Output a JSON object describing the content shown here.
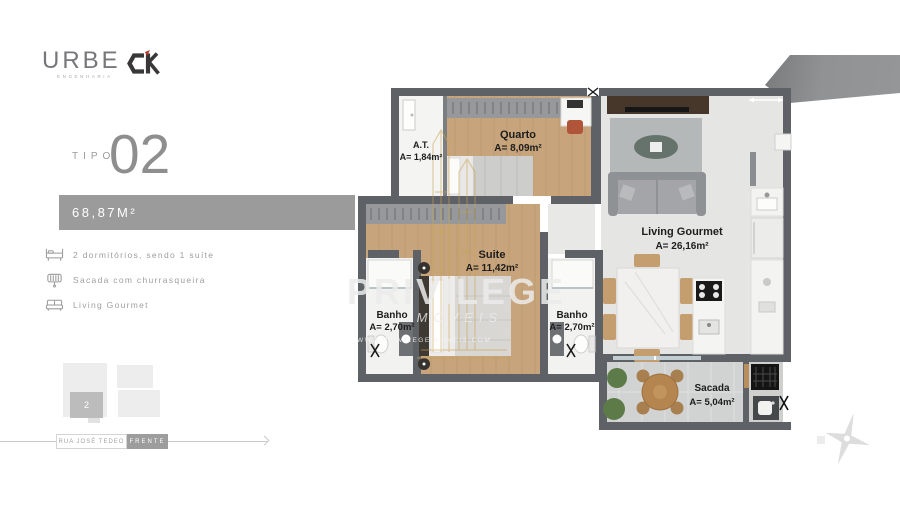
{
  "header": {
    "urbe_logo": "URBE",
    "urbe_tagline": "ENGENHARIA",
    "ck_logo": "CK"
  },
  "sidebar": {
    "tipo_label": "TIPO",
    "tipo_number": "02",
    "area_total": "68,87M²",
    "features": [
      {
        "icon": "bed-icon",
        "label": "2 dormitórios, sendo 1 suíte"
      },
      {
        "icon": "grill-icon",
        "label": "Sacada com churrasqueira"
      },
      {
        "icon": "sofa-icon",
        "label": "Living Gourmet"
      }
    ],
    "keyplan": {
      "unit_number": "2"
    },
    "street": {
      "name": "RUA JOSÉ TEDEO",
      "front": "FRENTE"
    }
  },
  "plan": {
    "rooms": [
      {
        "name": "A.T.",
        "area": "A= 1,84m²"
      },
      {
        "name": "Quarto",
        "area": "A= 8,09m²"
      },
      {
        "name": "Suite",
        "area": "A= 11,42m²"
      },
      {
        "name": "Banho",
        "area": "A= 2,70m²"
      },
      {
        "name": "Banho",
        "area": "A= 2,70m²"
      },
      {
        "name": "Living Gourmet",
        "area": "A= 26,16m²"
      },
      {
        "name": "Sacada",
        "area": "A= 5,04m²"
      }
    ]
  },
  "watermark": {
    "brand": "PRIVILEGE",
    "segment": "IMÓVEIS",
    "site": "WWW.PRIVILEGEIMOVEIS.COM"
  },
  "colors": {
    "wall": "#5e6165",
    "wood_floor": "#c7a47b",
    "bath_floor": "#f2f2f0",
    "living_floor": "#e5e5e3",
    "balcony_floor": "#d1d3d2",
    "accent_gold": "#c8a452",
    "badge_gray": "#9b9b9b",
    "chair_red": "#b0543a",
    "plant_green": "#5d7b49",
    "ribbon_gray": "#909294"
  }
}
